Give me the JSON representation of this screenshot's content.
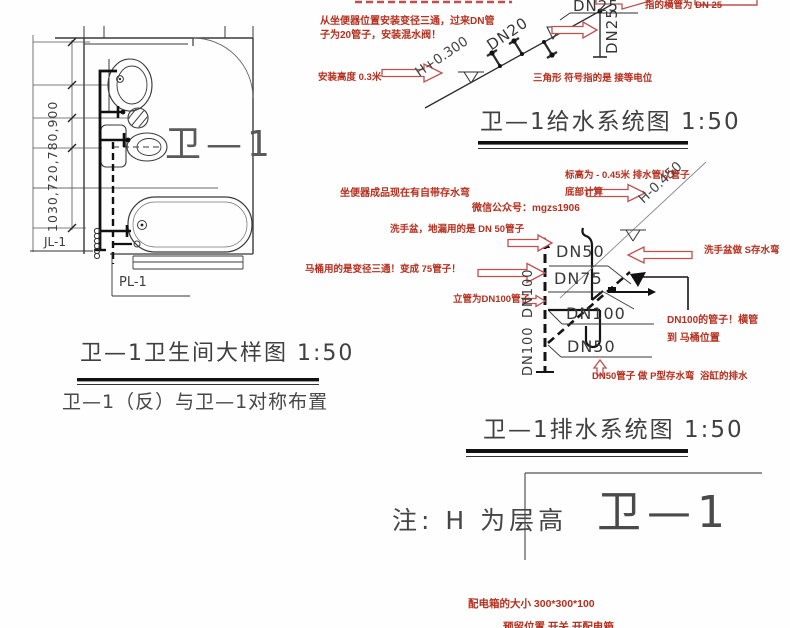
{
  "colors": {
    "red": "#b5301f",
    "line": "#2f2f2f"
  },
  "plan": {
    "dim_text": "1030,720,780,900",
    "room_label": "卫—1",
    "jl_label": "JL-1",
    "pl_label": "PL-1",
    "title": "卫—1卫生间大样图 1:50",
    "subtitle": "卫—1（反）与卫—1对称布置"
  },
  "supply": {
    "title": "卫—1给水系统图  1:50",
    "dn20": "DN20",
    "dn25_top": "DN25",
    "dn25_riser": "DN25",
    "elev": "H+0.300",
    "note_tee_1": "从坐便器位置安装变径三通，过来DN管",
    "note_tee_2": "子为20管子，安装混水阀！",
    "note_height": "安装高度 0.3米",
    "note_dn25": "指的横管为 DN 25",
    "note_triangle": "三角形 符号指的是 接等电位"
  },
  "drain": {
    "title": "卫—1排水系统图  1:50",
    "dn50_top": "DN50",
    "dn75": "DN75",
    "dn100_riser_1": "DN100",
    "dn100_riser_2": "DN100",
    "dn100_branch": "DN100",
    "dn50_tub": "DN50",
    "elev": "H-0.450",
    "note_toilet": "坐便器成品现在有自带存水弯",
    "note_elev_1": "标高为 - 0.45米 排水管以管子",
    "note_elev_2": "底部计算",
    "note_wechat": "微信公众号：mgzs1906",
    "note_basin": "洗手盆，地漏用的是 DN 50管子",
    "note_strap": "洗手盆做 S存水弯",
    "note_tee": "马桶用的是变径三通！变成 75管子！",
    "note_riser": "立管为DN100管子",
    "note_dn100_1": "DN100的管子！横管",
    "note_dn100_2": "到 马桶位置",
    "note_ptrap": "DN50管子 做 P型存水弯",
    "note_tub": "浴缸的排水"
  },
  "footer": {
    "note": "注: H 为层高",
    "tag": "卫—1",
    "elec_size": "配电箱的大小 300*300*100",
    "elec_partial": "预留位置 开关 开配电箱"
  }
}
